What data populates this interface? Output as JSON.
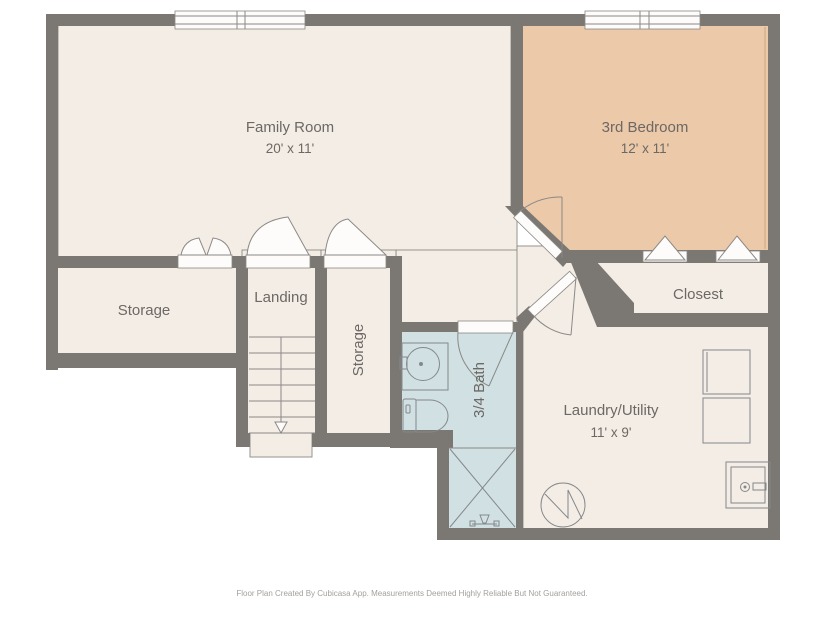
{
  "plan": {
    "title": "Basement floor plan",
    "rooms": [
      {
        "id": "family_room",
        "label": "Family Room",
        "dims": "20' x 11'"
      },
      {
        "id": "bedroom_3",
        "label": "3rd Bedroom",
        "dims": "12' x 11'"
      },
      {
        "id": "storage_left",
        "label": "Storage"
      },
      {
        "id": "landing",
        "label": "Landing"
      },
      {
        "id": "storage_mid",
        "label": "Storage"
      },
      {
        "id": "bath_34",
        "label": "3/4 Bath"
      },
      {
        "id": "closet",
        "label": "Closest"
      },
      {
        "id": "laundry_utility",
        "label": "Laundry/Utility",
        "dims": "11' x 9'"
      }
    ],
    "fixtures": [
      "sink-vanity",
      "toilet",
      "shower",
      "washer",
      "dryer",
      "utility-sink",
      "water-heater",
      "stairs-down-arrow"
    ],
    "footer": "Floor Plan Created By Cubicasa App. Measurements Deemed Highly Reliable But Not Guaranteed.",
    "colors": {
      "wall": "#7b7874",
      "floor": "#f4ede6",
      "bedroom_floor": "#ecc9a9",
      "bath_floor": "#d0e0e3",
      "threshold": "#fdfcfa",
      "outline": "#8b8885",
      "label_text": "#6c6864",
      "footer_text": "#a3a19d",
      "background": "#ffffff"
    }
  }
}
